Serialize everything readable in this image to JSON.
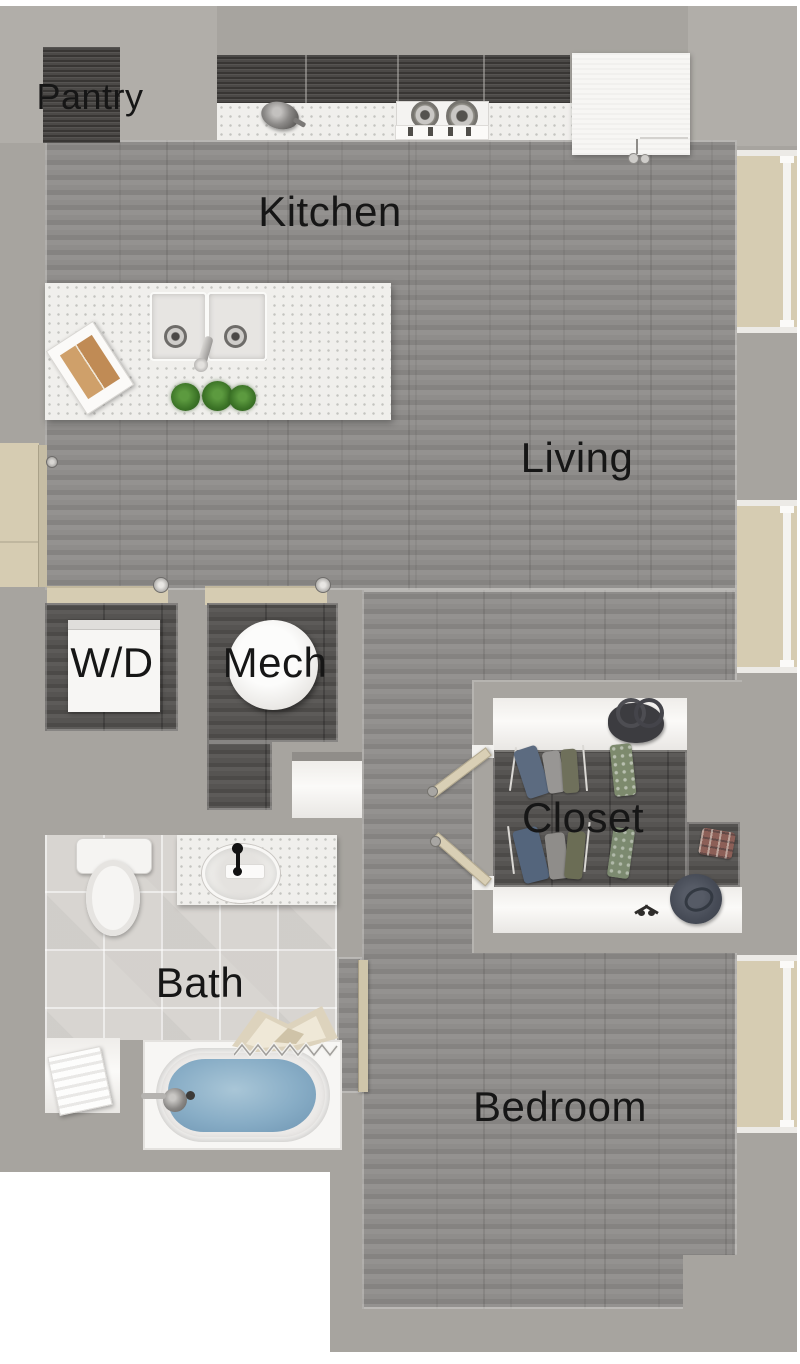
{
  "plan": {
    "name": "studio-apartment-floor-plan",
    "view": "top-down-3d-render"
  },
  "rooms": {
    "pantry": {
      "label": "Pantry"
    },
    "kitchen": {
      "label": "Kitchen"
    },
    "living": {
      "label": "Living"
    },
    "wd": {
      "label": "W/D"
    },
    "mech": {
      "label": "Mech"
    },
    "closet": {
      "label": "Closet"
    },
    "bath": {
      "label": "Bath"
    },
    "bedroom": {
      "label": "Bedroom"
    }
  },
  "fixtures": {
    "kitchen": [
      "pantry-cabinet",
      "upper-cabinets",
      "cooktop",
      "pot",
      "refrigerator",
      "island",
      "double-sink",
      "faucet",
      "cookbook",
      "herb-plants"
    ],
    "utility": [
      "washer-dryer-unit",
      "water-heater"
    ],
    "bath": [
      "toilet",
      "vanity-sink",
      "towel-shelf",
      "bathtub",
      "shower-curtain",
      "draped-towel"
    ],
    "closet": [
      "top-shelf",
      "bottom-shelf",
      "hanging-clothes",
      "handbag",
      "hat",
      "sunglasses"
    ]
  },
  "doors": {
    "entry": "left-wall-hinged",
    "wd": "sliding",
    "mech": "sliding",
    "closet": "double-hinged-open",
    "bath": "hinged-open"
  },
  "windows": {
    "count": 3,
    "location": "right-wall"
  },
  "palette": {
    "wall": "#a7a49f",
    "floor_wood": "#8b8987",
    "floor_dark": "#545250",
    "cabinet": "#454341",
    "counter": "#f0efec",
    "tile": "#d8d5d1",
    "door_window_beige": "#d6ccb2",
    "water": "#86abc4",
    "label_text": "#161616",
    "background": "#ffffff"
  }
}
